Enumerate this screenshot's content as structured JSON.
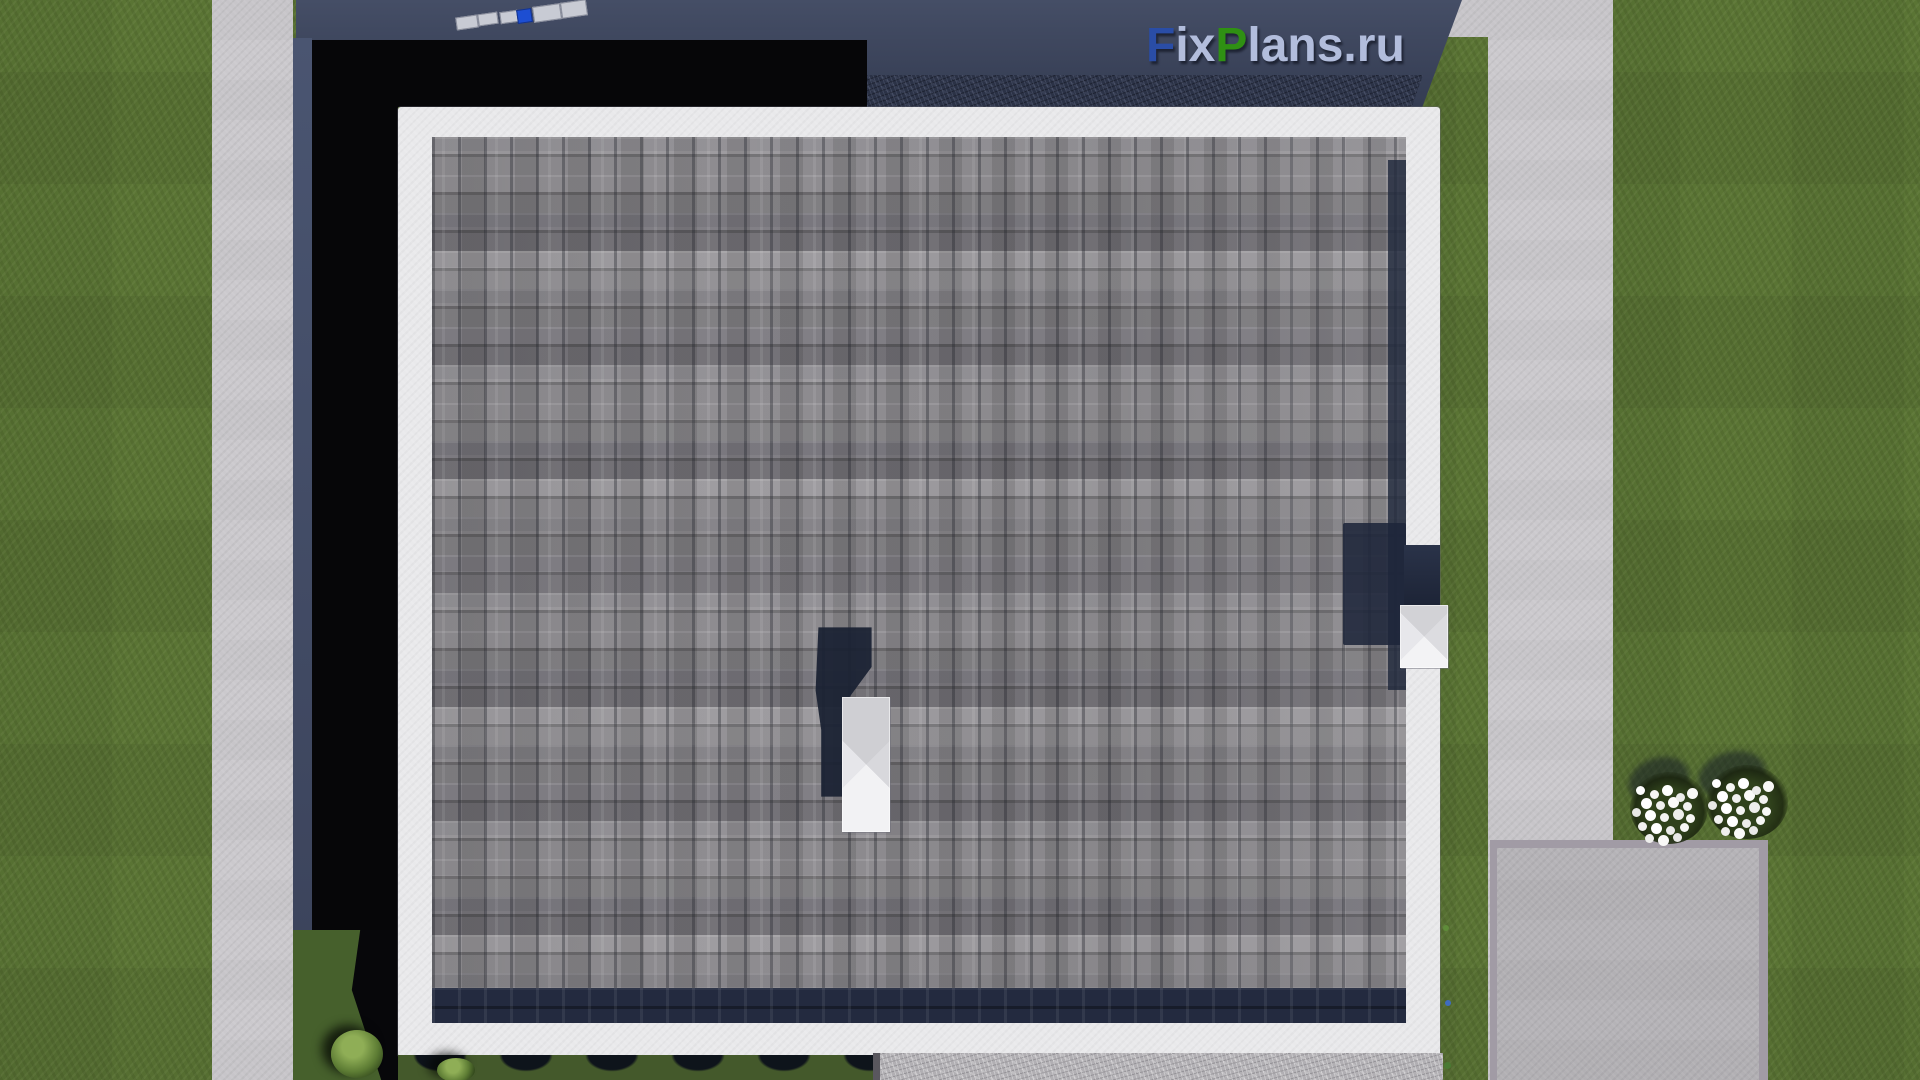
{
  "watermark": {
    "text": "FixPlans.ru",
    "segments": [
      {
        "text": "F",
        "style": "color:#2a4da6"
      },
      {
        "text": "ix",
        "style": "color:#b2bddc"
      },
      {
        "text": "P",
        "style": "color:#2f9013"
      },
      {
        "text": "lans",
        "style": "color:#b2bddc"
      },
      {
        "text": ".ru",
        "style": "color:#b2bddc"
      }
    ]
  },
  "palette": {
    "grass": "#5a7434",
    "path": "#cbc9cd",
    "pad": "#b5b3b7",
    "pad_border": "#a19ba5",
    "roof_border": "#e9e9eb",
    "shingle_light": "#a5a3a7",
    "shingle_mid": "#8f8d91",
    "shingle_dark": "#7c7a7e",
    "shadow_black": "#060608",
    "shadow_navy_dark": "#343c52",
    "shadow_navy_light": "#454e66",
    "chimney": "#e8e8ec",
    "flower_white": "#ffffff",
    "solar_blue": "#1d4ed2"
  }
}
